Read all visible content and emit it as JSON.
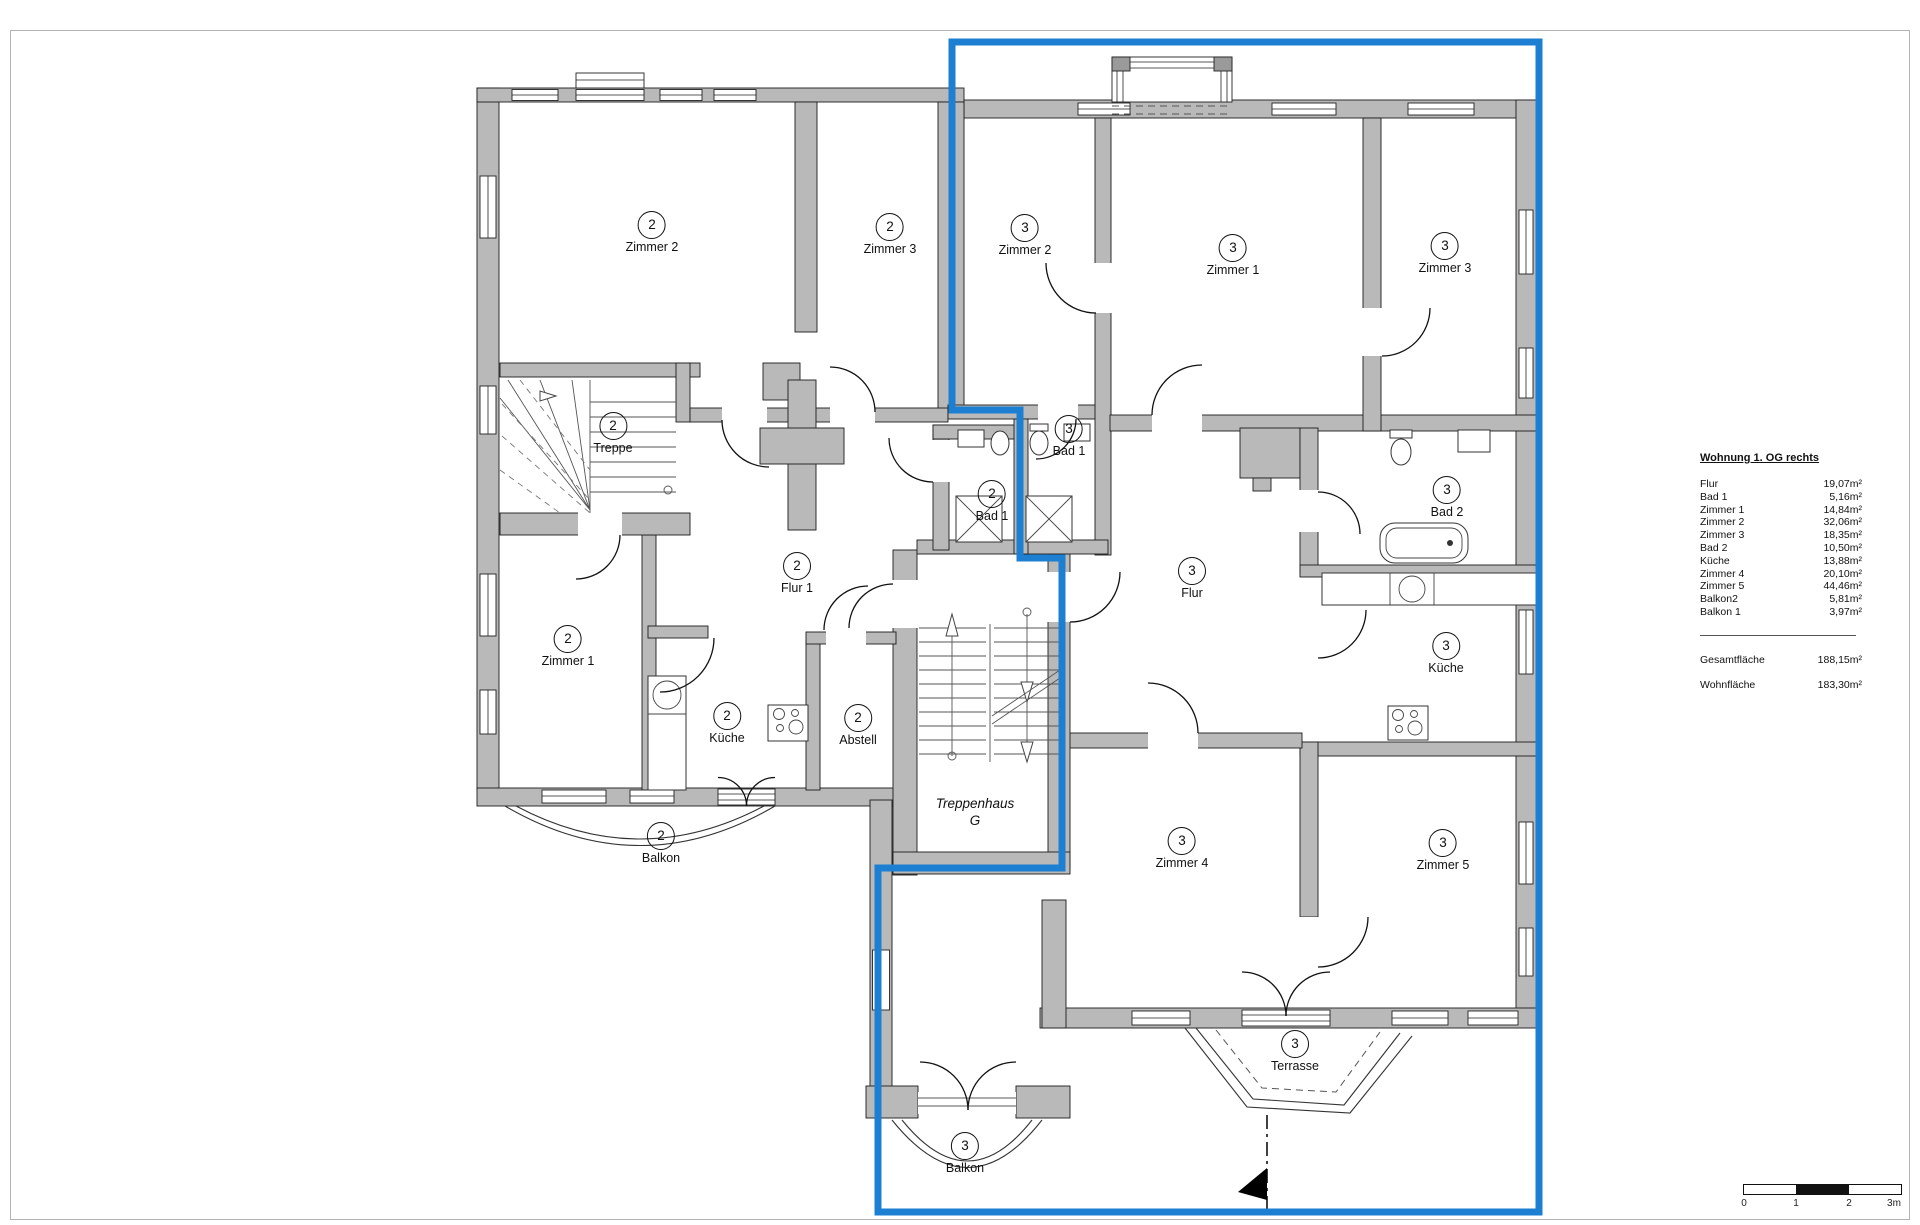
{
  "colors": {
    "highlight": "#1d7fd2",
    "wall": "#b9b9b9",
    "line": "#1c1c1c"
  },
  "plan": {
    "room_labels": [
      {
        "unit": "2",
        "name": "Zimmer 2",
        "x": 652,
        "y": 224
      },
      {
        "unit": "2",
        "name": "Zimmer 3",
        "x": 890,
        "y": 226
      },
      {
        "unit": "3",
        "name": "Zimmer 2",
        "x": 1025,
        "y": 227
      },
      {
        "unit": "3",
        "name": "Zimmer 1",
        "x": 1233,
        "y": 247
      },
      {
        "unit": "3",
        "name": "Zimmer 3",
        "x": 1445,
        "y": 245
      },
      {
        "unit": "2",
        "name": "Treppe",
        "x": 613,
        "y": 425
      },
      {
        "unit": "3",
        "name": "Bad 1",
        "x": 1069,
        "y": 428
      },
      {
        "unit": "2",
        "name": "Bad 1",
        "x": 992,
        "y": 493
      },
      {
        "unit": "3",
        "name": "Bad 2",
        "x": 1447,
        "y": 489
      },
      {
        "unit": "2",
        "name": "Flur 1",
        "x": 797,
        "y": 565
      },
      {
        "unit": "3",
        "name": "Flur",
        "x": 1192,
        "y": 570
      },
      {
        "unit": "2",
        "name": "Zimmer 1",
        "x": 568,
        "y": 638
      },
      {
        "unit": "2",
        "name": "Küche",
        "x": 727,
        "y": 715
      },
      {
        "unit": "3",
        "name": "Küche",
        "x": 1446,
        "y": 645
      },
      {
        "unit": "2",
        "name": "Abstell",
        "x": 858,
        "y": 717
      },
      {
        "unit": "2",
        "name": "Balkon",
        "x": 661,
        "y": 835
      },
      {
        "unit": "3",
        "name": "Zimmer 4",
        "x": 1182,
        "y": 840
      },
      {
        "unit": "3",
        "name": "Zimmer 5",
        "x": 1443,
        "y": 842
      },
      {
        "unit": "3",
        "name": "Terrasse",
        "x": 1295,
        "y": 1043
      },
      {
        "unit": "3",
        "name": "Balkon",
        "x": 965,
        "y": 1145
      }
    ],
    "stairwell_label": {
      "line1": "Treppenhaus",
      "line2": "G"
    }
  },
  "legend": {
    "title": "Wohnung 1. OG rechts",
    "rows": [
      {
        "label": "Flur",
        "value": "19,07m²"
      },
      {
        "label": "Bad 1",
        "value": "5,16m²"
      },
      {
        "label": "Zimmer 1",
        "value": "14,84m²"
      },
      {
        "label": "Zimmer 2",
        "value": "32,06m²"
      },
      {
        "label": "Zimmer 3",
        "value": "18,35m²"
      },
      {
        "label": "Bad 2",
        "value": "10,50m²"
      },
      {
        "label": "Küche",
        "value": "13,88m²"
      },
      {
        "label": "Zimmer 4",
        "value": "20,10m²"
      },
      {
        "label": "Zimmer 5",
        "value": "44,46m²"
      },
      {
        "label": "Balkon2",
        "value": "5,81m²"
      },
      {
        "label": "Balkon 1",
        "value": "3,97m²"
      }
    ],
    "totals": [
      {
        "label": "Gesamtfläche",
        "value": "188,15m²"
      },
      {
        "label": "Wohnfläche",
        "value": "183,30m²"
      }
    ]
  },
  "scale_bar": {
    "labels": [
      "0",
      "1",
      "2",
      "3m"
    ]
  }
}
